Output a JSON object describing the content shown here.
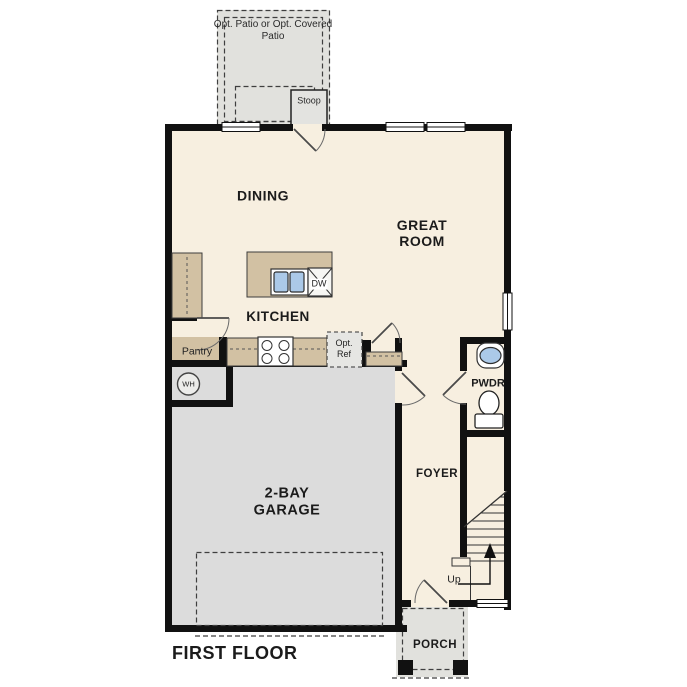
{
  "floorplan": {
    "title": "FIRST FLOOR",
    "labels": {
      "patio": "Opt. Patio or Opt. Covered Patio",
      "stoop": "Stoop",
      "dining": "DINING",
      "great_room": "GREAT ROOM",
      "kitchen": "KITCHEN",
      "pantry": "Pantry",
      "opt_ref": "Opt. Ref",
      "dw": "DW",
      "wh": "WH",
      "pwdr": "PWDR",
      "foyer": "FOYER",
      "garage": "2-BAY GARAGE",
      "up": "Up",
      "porch": "PORCH"
    },
    "colors": {
      "wall": "#111111",
      "interior_floor": "#f7efe0",
      "garage_floor": "#dcdcdc",
      "outdoor_concrete": "#e1e1dd",
      "cabinetry": "#d2c1a3",
      "sink_basin": "#abc9e8"
    }
  }
}
